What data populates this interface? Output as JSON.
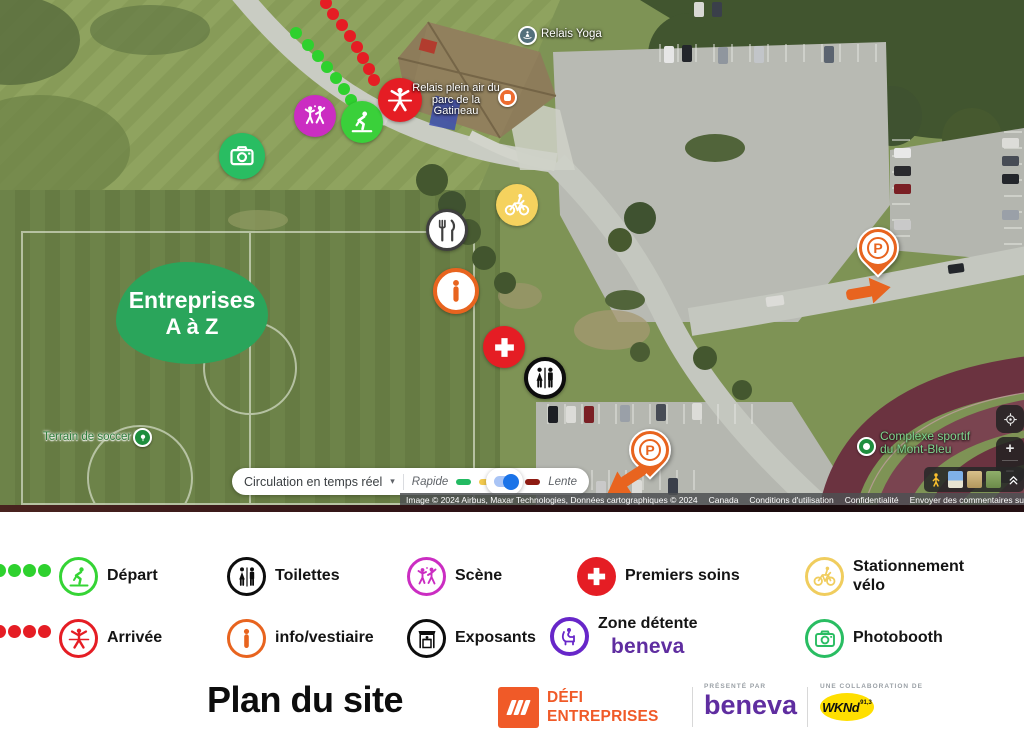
{
  "map": {
    "poi": {
      "relais_yoga": "Relais Yoga",
      "relais_plein_air_line1": "Relais plein air du",
      "relais_plein_air_line2": "parc de la Gatineau",
      "terrain_soccer": "Terrain de soccer 5",
      "complexe_sportif_line1": "Complexe sportif",
      "complexe_sportif_line2": "du Mont-Bleu"
    },
    "entreprises_badge": {
      "line1": "Entreprises",
      "line2": "A à Z"
    },
    "traffic_control": {
      "label": "Circulation en temps réel",
      "caret": "▾",
      "fast_label": "Rapide",
      "slow_label": "Lente",
      "segment_colors": [
        "#23ba62",
        "#f2c94c",
        "#e8563f",
        "#8e1b12"
      ]
    },
    "zoom_controls": {
      "zoom_in": "+",
      "zoom_out": "−"
    },
    "attribution": {
      "imagery": "Image © 2024 Airbus, Maxar Technologies, Données cartographiques © 2024",
      "link_canada": "Canada",
      "link_terms": "Conditions d'utilisation",
      "link_privacy": "Confidentialité",
      "link_feedback": "Envoyer des commentaires sur le produit",
      "scale_label": "10 m"
    },
    "markers": [
      {
        "name": "trail-depart",
        "type": "dotted-trail",
        "color": "#2ed12e"
      },
      {
        "name": "trail-arrivee",
        "type": "dotted-trail",
        "color": "#e51d24"
      },
      {
        "name": "scene",
        "icon": "dancers-icon",
        "color": "#cb2dc2"
      },
      {
        "name": "depart",
        "icon": "ski-start-icon",
        "color": "#35d435"
      },
      {
        "name": "arrivee",
        "icon": "finish-line-icon",
        "color": "#e51d24"
      },
      {
        "name": "photobooth",
        "icon": "camera-icon",
        "color": "#29bd62"
      },
      {
        "name": "stationnement-velo",
        "icon": "bike-icon",
        "color": "#f5d25e"
      },
      {
        "name": "nourriture",
        "icon": "fork-knife-icon",
        "color": "#3f3f3f"
      },
      {
        "name": "info-vestiaire",
        "icon": "info-icon",
        "color": "#e8641f"
      },
      {
        "name": "premiers-soins",
        "icon": "medical-cross-icon",
        "color": "#e51d24"
      },
      {
        "name": "toilettes",
        "icon": "toilets-icon",
        "color": "#0d0d0d"
      },
      {
        "name": "stationnement-auto-1",
        "icon": "parking-pin-icon",
        "color": "#e8641f",
        "label": "P"
      },
      {
        "name": "stationnement-auto-2",
        "icon": "parking-pin-icon",
        "color": "#e8641f",
        "label": "P"
      },
      {
        "name": "zone-entreprises",
        "label": "Entreprises A à Z",
        "color": "#2aa55b"
      }
    ]
  },
  "legend": {
    "rows": [
      {
        "trail_color": "#2ed12e",
        "items": [
          {
            "label": "Départ",
            "icon": "ski-start-icon",
            "color": "#35d435",
            "style": "ring"
          },
          {
            "label": "Toilettes",
            "icon": "toilets-icon",
            "color": "#0d0d0d",
            "style": "ring"
          },
          {
            "label": "Scène",
            "icon": "dancers-icon",
            "color": "#cb2dc2",
            "style": "ring"
          },
          {
            "label": "Premiers soins",
            "icon": "medical-cross-icon",
            "color": "#e51d24",
            "style": "solid"
          },
          {
            "label": "Stationnement vélo",
            "icon": "bike-icon",
            "color": "#f0cd5e",
            "style": "ring"
          }
        ]
      },
      {
        "trail_color": "#e51d24",
        "items": [
          {
            "label": "Arrivée",
            "icon": "finish-line-icon",
            "color": "#e51d24",
            "style": "ring"
          },
          {
            "label": "info/vestiaire",
            "icon": "info-icon",
            "color": "#e8641f",
            "style": "ring"
          },
          {
            "label": "Exposants",
            "icon": "kiosk-icon",
            "color": "#0d0d0d",
            "style": "ring"
          },
          {
            "label": "Zone détente",
            "sponsor": "beneva",
            "icon": "lounge-chair-icon",
            "color": "#6726c9",
            "style": "ring"
          },
          {
            "label": "Photobooth",
            "icon": "camera-icon",
            "color": "#29bd62",
            "style": "ring"
          }
        ]
      }
    ]
  },
  "footer": {
    "title": "Plan du site",
    "defi": {
      "line1": "DÉFI",
      "line2": "ENTREPRISES"
    },
    "beneva": {
      "tagline": "PRÉSENTÉ PAR",
      "brand": "beneva"
    },
    "wknd": {
      "tagline": "UNE COLLABORATION DE",
      "brand": "WKNd",
      "frequency": "91,3"
    }
  }
}
